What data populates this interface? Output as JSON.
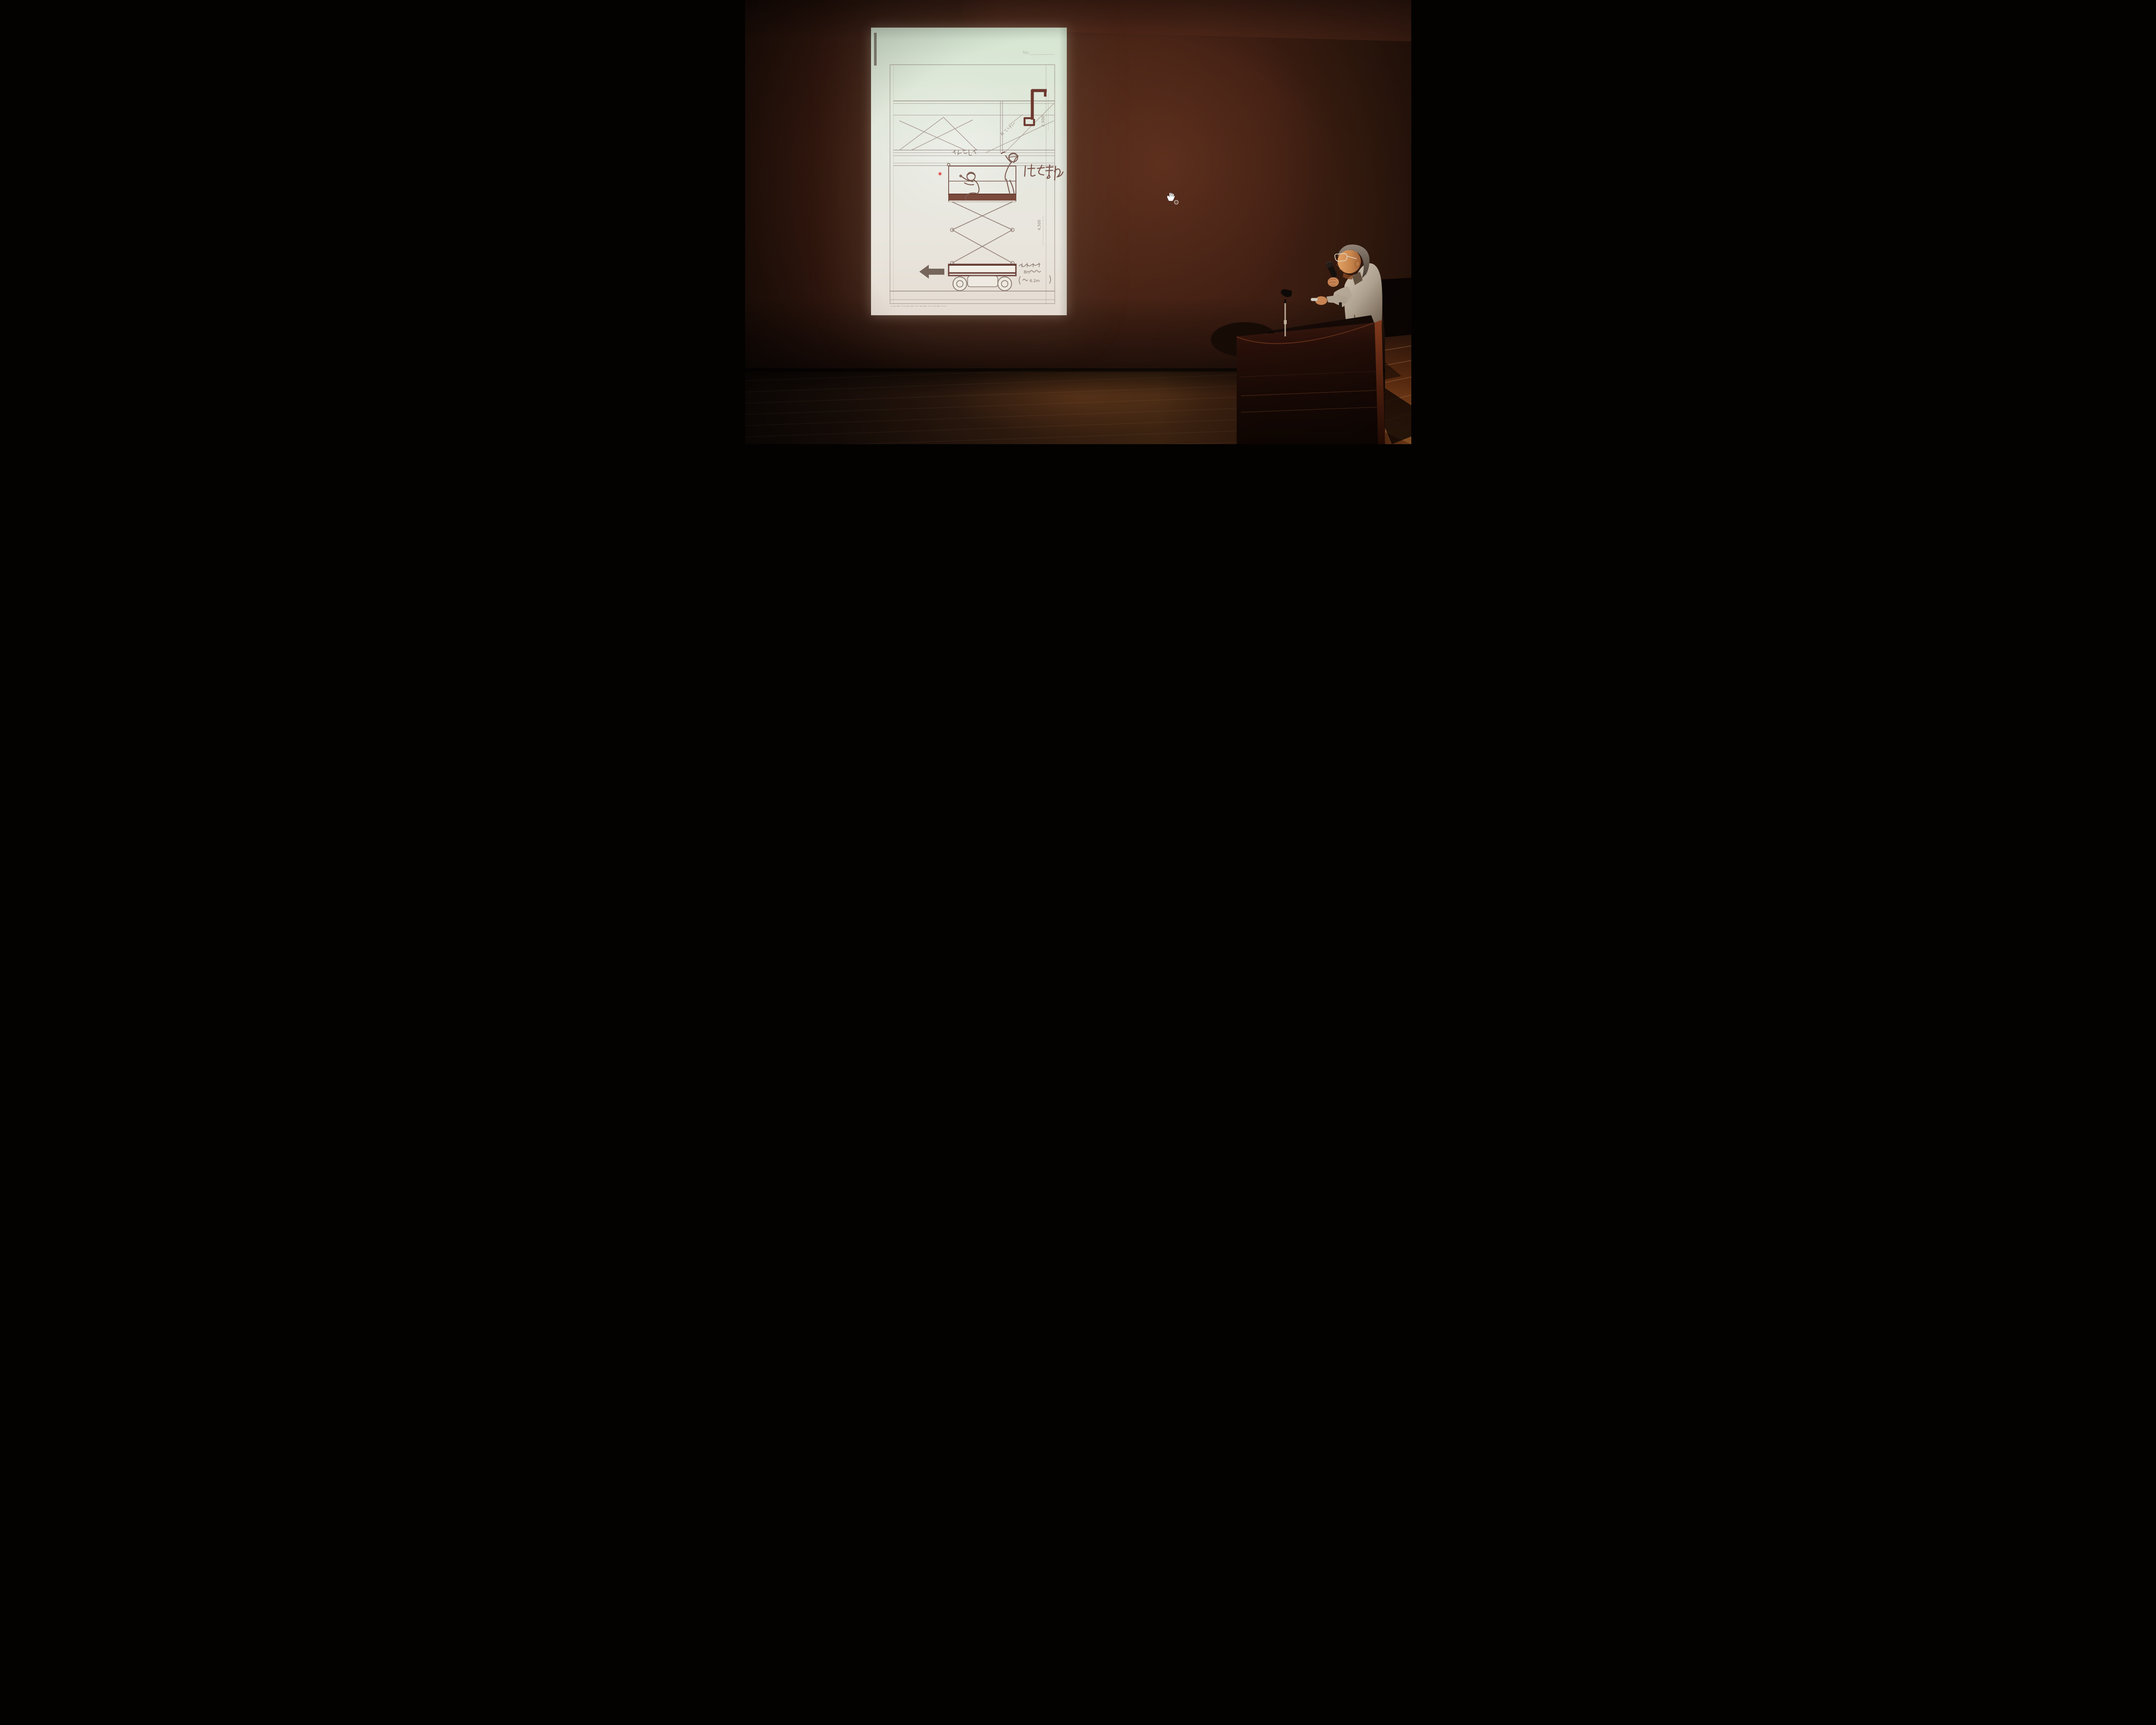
{
  "scene": {
    "type": "photograph",
    "setting": "Dim auditorium: a speaker at a dark wooden podium presents a projected hand-drawn industrial-safety sketch",
    "colors": {
      "wall": "#3f1e15",
      "wall_dark": "#2a140d",
      "wall_panel_top": "#4d2517",
      "stage_wing_black": "#0c0504",
      "floor_lit": "#cf7430",
      "floor_dark": "#1c0f09",
      "slide_paper_top": "#d9e6d3",
      "slide_paper_bottom": "#e6ddd4",
      "sketch_ink": "#94807a",
      "sketch_dark_ink": "#6e382e",
      "laser_dot": "#e23030",
      "cursor": "#ffffff",
      "podium_wood": "#250f08",
      "podium_lit_edge": "#8a3c1e",
      "shirt": "#c2b3a0",
      "skin": "#d08a4e"
    }
  },
  "slide": {
    "sheet_label": "No.",
    "drawing_subject": "Scissor-lift aerial work platform with two workers below a ceiling H-beam, braces and a hanging duct — pinch-point hazard sketch",
    "annotations": {
      "hazard": "はさまれ",
      "brace_note": "ブレスじゃま",
      "duct_note": "Hダクト吊り",
      "dim_upper": "2,500",
      "dim_lower": "4,500",
      "machine_note_line1": "高所作業台",
      "machine_note_line2": "8mタイプ",
      "machine_note_line3": "(床高 6.2m)",
      "visible_fragments": {
        "type_8m": "8m",
        "floor_height": "6.2m"
      }
    }
  },
  "pointer": {
    "style": "hand-cursor",
    "laser_dot": "red"
  },
  "presenter": {
    "description": "Elderly man, glasses, receding grey hair, light grey work shirt, speaking into a handheld microphone",
    "holding": "microphone and small presenter remote"
  },
  "podium": {
    "material": "dark polished wood, horizontal trim grooves",
    "equipment": "empty microphone stand clip"
  }
}
